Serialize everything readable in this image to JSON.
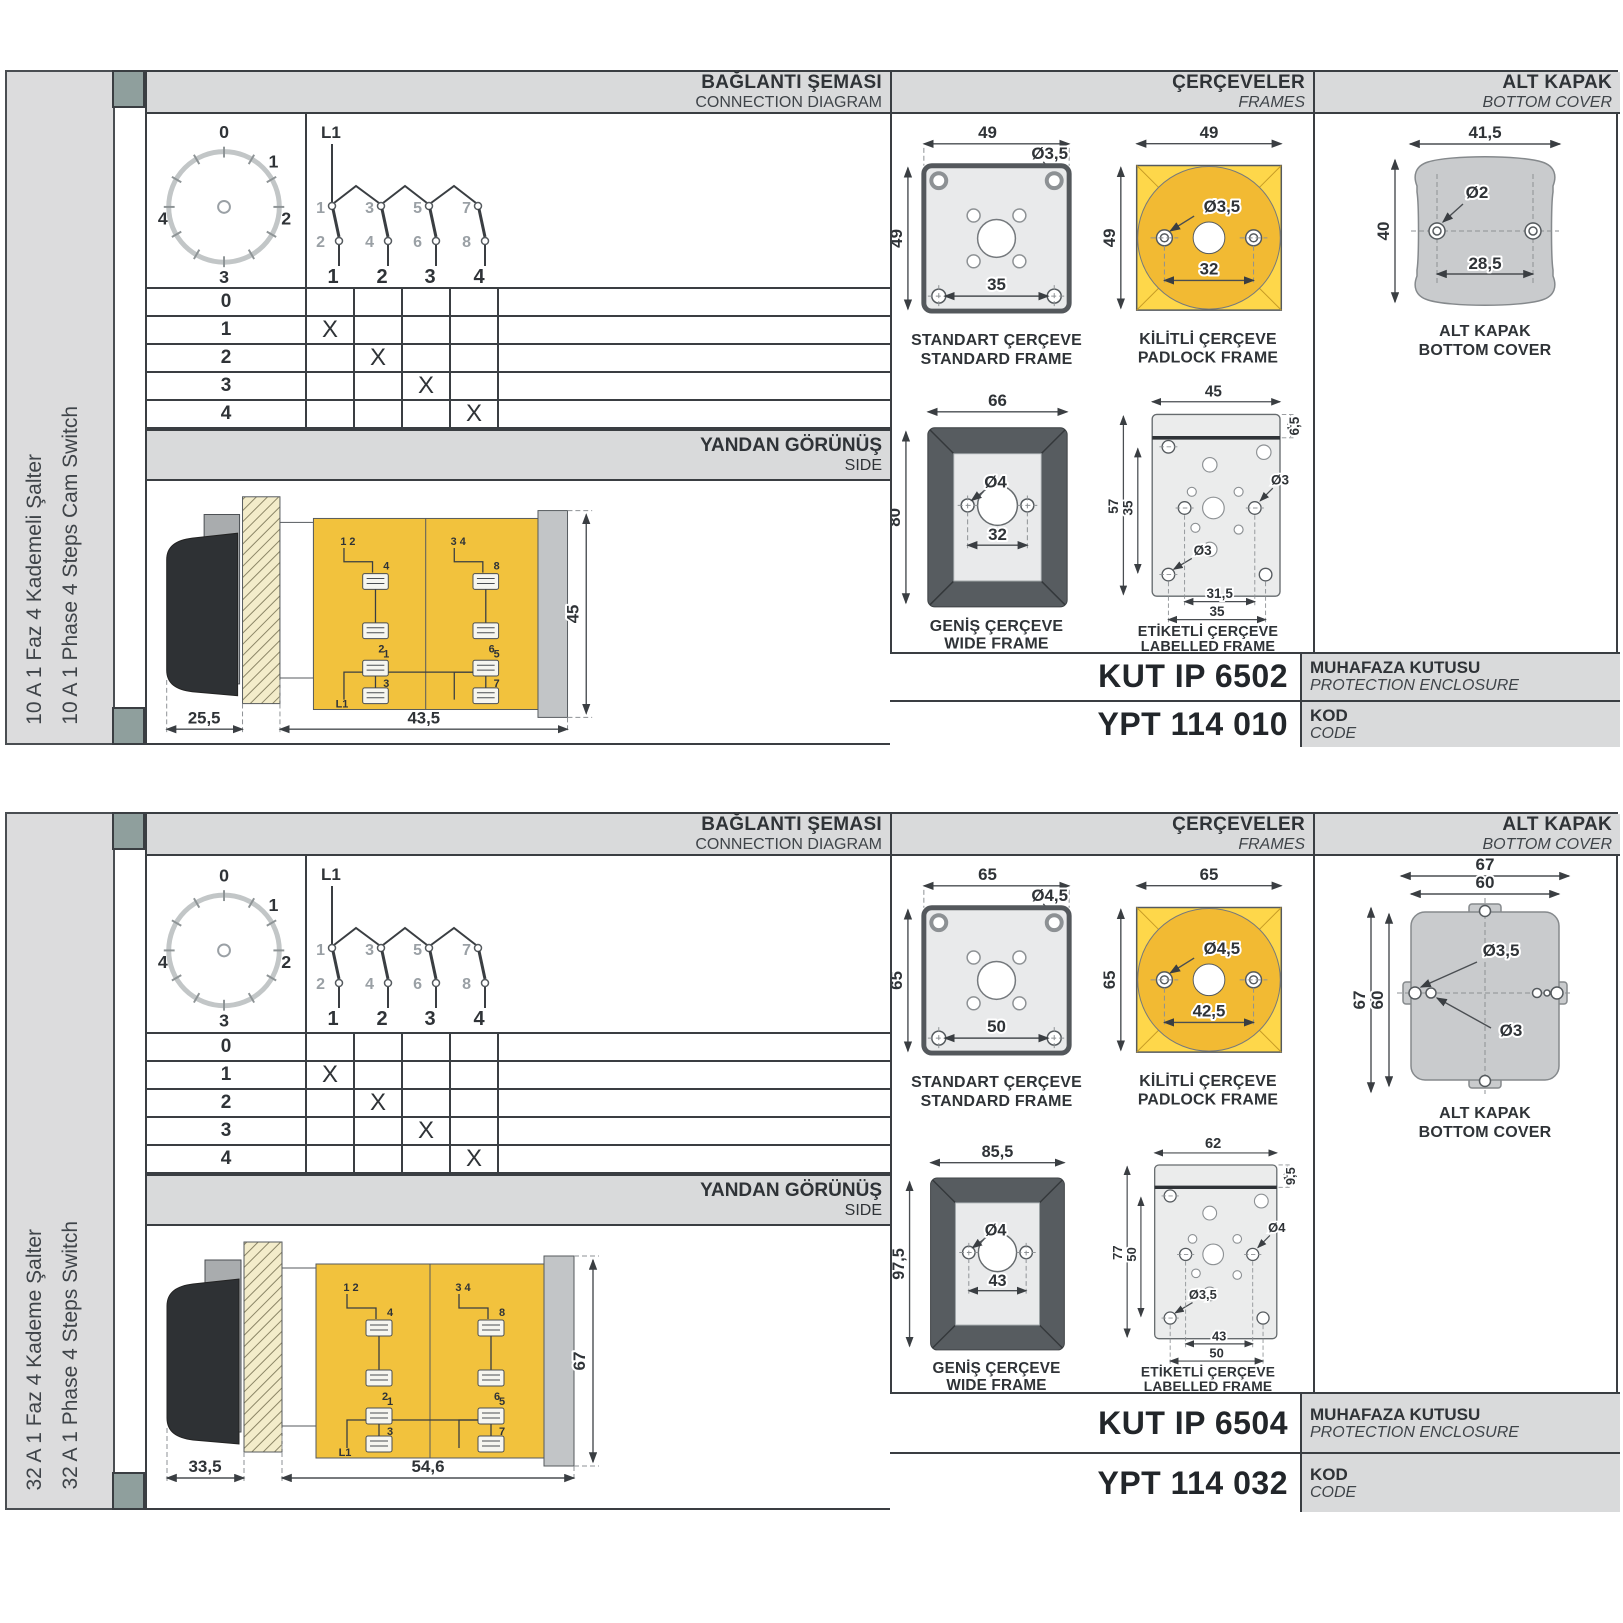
{
  "colors": {
    "band-bg": "#d9dadb",
    "panel-bg": "#dcdcdd",
    "ink": "#2f3337",
    "line": "#3a3e42",
    "draw-line": "#4a4e52",
    "light-fill": "#e9eaeb",
    "yellow": "#f2c23d",
    "yellow-bright": "#fed74a",
    "yellow-deep": "#f2ba33",
    "cream": "#f3ecca",
    "dark-frame": "#575c60",
    "cover-grey": "#c9cbcd",
    "sq-grey": "#8f9f9d",
    "dim-grey": "#9aa0a5"
  },
  "headers": {
    "connection_tr": "BAĞLANTI ŞEMASI",
    "connection_en": "CONNECTION DIAGRAM",
    "frames_tr": "ÇERÇEVELER",
    "frames_en": "FRAMES",
    "cover_tr": "ALT KAPAK",
    "cover_en": "BOTTOM COVER",
    "side_tr": "YANDAN GÖRÜNÜŞ",
    "side_en": "SIDE",
    "enclosure_tr": "MUHAFAZA KUTUSU",
    "enclosure_en": "PROTECTION ENCLOSURE",
    "code_tr": "KOD",
    "code_en": "CODE"
  },
  "captions": {
    "standard_tr": "STANDART ÇERÇEVE",
    "standard_en": "STANDARD FRAME",
    "padlock_tr": "KİLİTLİ ÇERÇEVE",
    "padlock_en": "PADLOCK FRAME",
    "wide_tr": "GENİŞ ÇERÇEVE",
    "wide_en": "WIDE FRAME",
    "labelled_tr": "ETİKETLİ ÇERÇEVE",
    "labelled_en": "LABELLED FRAME",
    "cover_tr": "ALT KAPAK",
    "cover_en": "BOTTOM COVER"
  },
  "diagram": {
    "phase": "L1",
    "dial": [
      "0",
      "1",
      "2",
      "3",
      "4"
    ],
    "contacts_top": [
      "1",
      "3",
      "5",
      "7"
    ],
    "contacts_bottom": [
      "2",
      "4",
      "6",
      "8"
    ],
    "columns": [
      "1",
      "2",
      "3",
      "4"
    ],
    "table": [
      {
        "pos": "0",
        "m": [
          "",
          "",
          "",
          ""
        ]
      },
      {
        "pos": "1",
        "m": [
          "X",
          "",
          "",
          ""
        ]
      },
      {
        "pos": "2",
        "m": [
          "",
          "X",
          "",
          ""
        ]
      },
      {
        "pos": "3",
        "m": [
          "",
          "",
          "X",
          ""
        ]
      },
      {
        "pos": "4",
        "m": [
          "",
          "",
          "",
          "X"
        ]
      }
    ]
  },
  "side_view": {
    "pair_left": "1 2",
    "pair_right": "3 4",
    "tA1": "4",
    "tA2": "2",
    "tA3": "1",
    "tA4": "3",
    "tB1": "8",
    "tB2": "6",
    "tB3": "5",
    "tB4": "7",
    "phase": "L1"
  },
  "rows": [
    {
      "title_tr": "10 A 1 Faz 4 Kademeli Şalter",
      "title_en": "10 A 1 Phase 4 Steps Cam Switch",
      "side": {
        "handle": "25,5",
        "body": "43,5",
        "height": "45"
      },
      "standard": {
        "w": "49",
        "h": "49",
        "hole": "Ø3,5",
        "span": "35"
      },
      "padlock": {
        "w": "49",
        "h": "49",
        "hole": "Ø3,5",
        "span": "32"
      },
      "wide": {
        "w": "66",
        "h": "80",
        "hole": "Ø4",
        "span": "32"
      },
      "labelled": {
        "w": "45",
        "h": "57",
        "inner": "35",
        "strip": "6,5",
        "hole_mid": "Ø3",
        "hole_low": "Ø3",
        "span1": "31,5",
        "span2": "35"
      },
      "cover": {
        "w": "41,5",
        "h": "40",
        "hole": "Ø2",
        "span": "28,5"
      },
      "enclosure": "KUT IP 6502",
      "code": "YPT 114 010"
    },
    {
      "title_tr": "32 A 1 Faz 4 Kademe Şalter",
      "title_en": "32 A 1 Phase 4 Steps Switch",
      "side": {
        "handle": "33,5",
        "body": "54,6",
        "height": "67"
      },
      "standard": {
        "w": "65",
        "h": "65",
        "hole": "Ø4,5",
        "span": "50"
      },
      "padlock": {
        "w": "65",
        "h": "65",
        "hole": "Ø4,5",
        "span": "42,5"
      },
      "wide": {
        "w": "85,5",
        "h": "97,5",
        "hole": "Ø4",
        "span": "43"
      },
      "labelled": {
        "w": "62",
        "h": "77",
        "inner": "50",
        "strip": "9,5",
        "hole_mid": "Ø4",
        "hole_low": "Ø3,5",
        "span1": "43",
        "span2": "50"
      },
      "cover": {
        "w": "67",
        "w2": "60",
        "h": "67",
        "h2": "60",
        "hole1": "Ø3,5",
        "hole2": "Ø3"
      },
      "enclosure": "KUT IP 6504",
      "code": "YPT 114 032"
    }
  ]
}
